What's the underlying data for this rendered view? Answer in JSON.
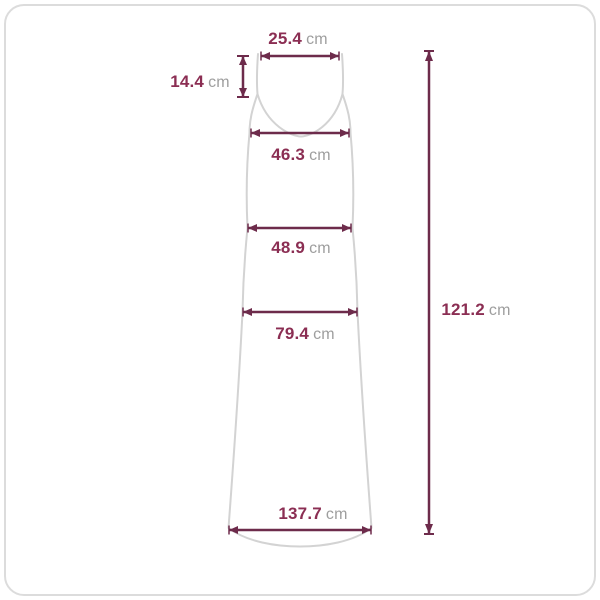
{
  "diagram_type": "garment-size-measurement",
  "garment": "sleeveless-maxi-dress",
  "measurements": {
    "top_width": {
      "value": "25.4",
      "unit": "cm"
    },
    "strap_length": {
      "value": "14.4",
      "unit": "cm"
    },
    "bust_width": {
      "value": "46.3",
      "unit": "cm"
    },
    "waist_width": {
      "value": "48.9",
      "unit": "cm"
    },
    "hip_width": {
      "value": "79.4",
      "unit": "cm"
    },
    "hem_width": {
      "value": "137.7",
      "unit": "cm"
    },
    "total_length": {
      "value": "121.2",
      "unit": "cm"
    }
  },
  "colors": {
    "measurement_line": "#6d2b4b",
    "value_text": "#8b2e53",
    "unit_text": "#9e9e9e",
    "garment_outline": "#d3d3d3",
    "frame_border": "#dcdcdc",
    "background": "#ffffff"
  }
}
